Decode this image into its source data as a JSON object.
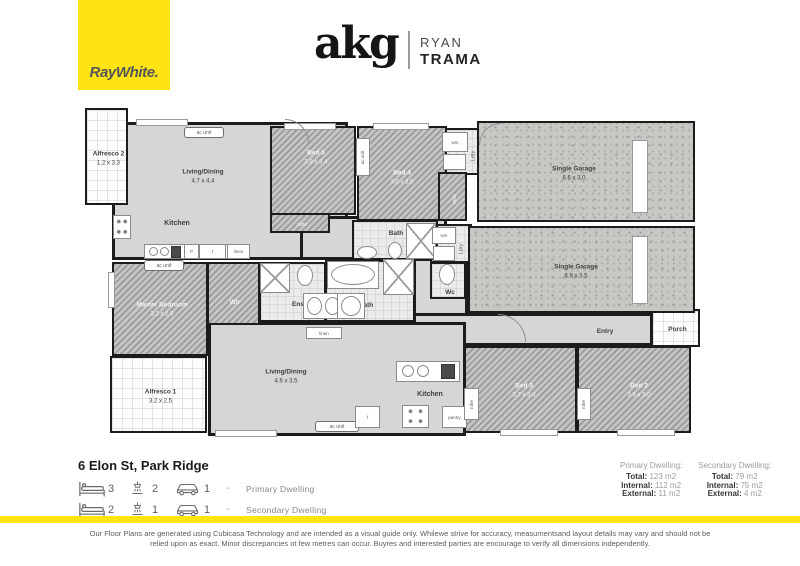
{
  "colors": {
    "brand_yellow": "#FFE313",
    "wall": "#1c1c1c",
    "floor_hard": "#d6d6d4",
    "floor_garage": "#c6c8c3"
  },
  "header": {
    "raywhite_text": "RayWhite.",
    "agency_logo": "akg",
    "agent_first": "RYAN",
    "agent_last": "TRAMA"
  },
  "floorplan": {
    "rooms": [
      {
        "slug": "living-dining-secondary",
        "n": "Living/Dining",
        "d2": "4.7 x 4.4",
        "x": 112,
        "y": 122,
        "w": 236,
        "h": 138,
        "f": "hard",
        "lc": "dark",
        "base": 1,
        "lx": 200,
        "ly": 174
      },
      {
        "slug": "hall-secondary",
        "x": 300,
        "y": 216,
        "w": 147,
        "h": 44,
        "f": "hard",
        "base": 1
      },
      {
        "slug": "hall-primary",
        "x": 413,
        "y": 258,
        "w": 55,
        "h": 62,
        "f": "hard",
        "base": 1
      },
      {
        "slug": "entry",
        "n": "Entry",
        "x": 413,
        "y": 313,
        "w": 240,
        "h": 33,
        "f": "hard",
        "lc": "dark",
        "base": 1,
        "lx": 602,
        "ly": 329
      },
      {
        "slug": "living-dining-primary",
        "n": "Living/Dining",
        "d2": "4.6 x 3.5",
        "x": 208,
        "y": 322,
        "w": 258,
        "h": 114,
        "f": "hard",
        "lc": "dark",
        "base": 1,
        "lx": 283,
        "ly": 374
      },
      {
        "slug": "alfresco-2",
        "n": "Alfresco 2",
        "d2": "1.2 x 3.3",
        "x": 85,
        "y": 108,
        "w": 43,
        "h": 97,
        "f": "tile",
        "lc": "dark"
      },
      {
        "slug": "alfresco-1",
        "n": "Alfresco 1",
        "d2": "3.2 x 2.5",
        "x": 110,
        "y": 356,
        "w": 97,
        "h": 77,
        "f": "tile",
        "lc": "dark"
      },
      {
        "slug": "porch",
        "n": "Porch",
        "x": 651,
        "y": 309,
        "w": 49,
        "h": 38,
        "f": "tile",
        "lc": "dark"
      },
      {
        "slug": "laundry-secondary",
        "x": 438,
        "y": 128,
        "w": 42,
        "h": 47,
        "f": "bathtile"
      },
      {
        "slug": "laundry-primary",
        "x": 430,
        "y": 224,
        "w": 42,
        "h": 39,
        "f": "bathtile"
      },
      {
        "slug": "bath-secondary",
        "n": "Bath",
        "x": 352,
        "y": 220,
        "w": 86,
        "h": 40,
        "f": "bathtile",
        "lc": "dark",
        "lx": 394,
        "ly": 232
      },
      {
        "slug": "ensuite",
        "n": "Ens",
        "x": 259,
        "y": 262,
        "w": 67,
        "h": 60,
        "f": "bathtile",
        "lc": "dark",
        "lx": 296,
        "ly": 303
      },
      {
        "slug": "bath-primary",
        "n": "Bath",
        "x": 325,
        "y": 260,
        "w": 90,
        "h": 62,
        "f": "bathtile",
        "lc": "dark",
        "lx": 364,
        "ly": 304
      },
      {
        "slug": "wc",
        "n": "Wc",
        "x": 430,
        "y": 262,
        "w": 36,
        "h": 37,
        "f": "bathtile",
        "lc": "dark",
        "lx": 448,
        "ly": 291
      },
      {
        "slug": "bed-5",
        "n": "Bed 5",
        "d2": "2.8 x 3.4",
        "x": 270,
        "y": 126,
        "w": 86,
        "h": 89,
        "f": "carpet",
        "lc": "light",
        "lx": 314,
        "ly": 156
      },
      {
        "slug": "robe-bed-5",
        "n": "robe",
        "x": 270,
        "y": 213,
        "w": 60,
        "h": 20,
        "f": "carpet",
        "lc": "light",
        "small": 1
      },
      {
        "slug": "bed-4",
        "n": "Bed 4",
        "d2": "3.0 x 3.0",
        "x": 357,
        "y": 126,
        "w": 90,
        "h": 95,
        "f": "carpet",
        "lc": "light",
        "lx": 400,
        "ly": 176
      },
      {
        "slug": "robe-bed-4",
        "n": "robe",
        "x": 438,
        "y": 172,
        "w": 29,
        "h": 49,
        "f": "carpet",
        "lc": "light",
        "small": 1,
        "v": 1
      },
      {
        "slug": "master-bedroom",
        "n": "Master Bedroom",
        "d2": "3.2 x 2.9",
        "x": 112,
        "y": 262,
        "w": 96,
        "h": 94,
        "f": "carpet",
        "lc": "light",
        "lx": 160,
        "ly": 308
      },
      {
        "slug": "walk-in-robe",
        "n": "WIr",
        "x": 207,
        "y": 262,
        "w": 53,
        "h": 63,
        "f": "carpet",
        "lc": "light",
        "lx": 233,
        "ly": 301
      },
      {
        "slug": "bed-3",
        "n": "Bed 3",
        "d2": "3.7 x 3.0",
        "x": 464,
        "y": 346,
        "w": 113,
        "h": 87,
        "f": "carpet",
        "lc": "light",
        "lx": 522,
        "ly": 389
      },
      {
        "slug": "bed-2",
        "n": "Bed 2",
        "d2": "3.6 x 3.0",
        "x": 577,
        "y": 346,
        "w": 114,
        "h": 87,
        "f": "carpet",
        "lc": "light",
        "lx": 637,
        "ly": 389
      },
      {
        "slug": "garage-secondary",
        "n": "Single Garage",
        "d2": "6.6 x 3.0",
        "x": 477,
        "y": 121,
        "w": 218,
        "h": 101,
        "f": "garage",
        "lc": "dark",
        "lx": 572,
        "ly": 172
      },
      {
        "slug": "garage-primary",
        "n": "Single Garage",
        "d2": "6.9 x 3.5",
        "x": 468,
        "y": 226,
        "w": 227,
        "h": 87,
        "f": "garage",
        "lc": "dark",
        "lx": 574,
        "ly": 270
      }
    ],
    "windows": [
      {
        "x": 136,
        "y": 119,
        "w": 52,
        "h": 7
      },
      {
        "x": 284,
        "y": 123,
        "w": 52,
        "h": 7
      },
      {
        "x": 373,
        "y": 123,
        "w": 56,
        "h": 7
      },
      {
        "x": 632,
        "y": 140,
        "w": 16,
        "h": 73
      },
      {
        "x": 632,
        "y": 236,
        "w": 16,
        "h": 68
      },
      {
        "x": 108,
        "y": 272,
        "w": 7,
        "h": 36
      },
      {
        "x": 215,
        "y": 430,
        "w": 62,
        "h": 7
      },
      {
        "x": 500,
        "y": 429,
        "w": 58,
        "h": 7
      },
      {
        "x": 617,
        "y": 429,
        "w": 58,
        "h": 7
      }
    ],
    "fixtures": [
      {
        "t": "badge",
        "x": 184,
        "y": 127,
        "w": 40,
        "h": 11,
        "l": "ac unit",
        "name": "ac-unit-badge"
      },
      {
        "t": "badge",
        "x": 144,
        "y": 260,
        "w": 40,
        "h": 11,
        "l": "ac unit",
        "name": "ac-unit-badge"
      },
      {
        "t": "badge",
        "x": 315,
        "y": 421,
        "w": 44,
        "h": 11,
        "l": "ac unit",
        "name": "ac-unit-badge"
      },
      {
        "t": "box",
        "x": 356,
        "y": 138,
        "w": 14,
        "h": 38,
        "l": "ac unit",
        "v": 1,
        "name": "ac-unit-badge"
      },
      {
        "t": "dots",
        "x": 113,
        "y": 215,
        "w": 18,
        "h": 24,
        "name": "stove-icon"
      },
      {
        "t": "box",
        "x": 144,
        "y": 244,
        "w": 106,
        "h": 15,
        "name": "kitchen-counter"
      },
      {
        "t": "oval",
        "x": 149,
        "y": 247,
        "w": 9,
        "h": 9,
        "name": "sink-icon"
      },
      {
        "t": "oval",
        "x": 160,
        "y": 247,
        "w": 9,
        "h": 9,
        "name": "sink-icon"
      },
      {
        "t": "dark",
        "x": 171,
        "y": 246,
        "w": 10,
        "h": 12,
        "name": "dishwasher-icon"
      },
      {
        "t": "box",
        "x": 184,
        "y": 244,
        "w": 15,
        "h": 15,
        "l": "P",
        "name": "pantry-box"
      },
      {
        "t": "box",
        "x": 199,
        "y": 244,
        "w": 27,
        "h": 15,
        "l": "f",
        "name": "fridge-box"
      },
      {
        "t": "box",
        "x": 227,
        "y": 244,
        "w": 23,
        "h": 15,
        "l": "linen",
        "name": "linen-box"
      },
      {
        "t": "oval",
        "x": 357,
        "y": 246,
        "w": 20,
        "h": 13,
        "name": "basin-icon"
      },
      {
        "t": "oval",
        "x": 388,
        "y": 242,
        "w": 14,
        "h": 17,
        "name": "toilet-icon"
      },
      {
        "t": "xbox",
        "x": 406,
        "y": 223,
        "w": 30,
        "h": 36,
        "name": "shower-box"
      },
      {
        "t": "box",
        "x": 442,
        "y": 132,
        "w": 26,
        "h": 20,
        "l": "wm",
        "name": "washing-machine-box"
      },
      {
        "t": "box",
        "x": 443,
        "y": 154,
        "w": 23,
        "h": 16,
        "name": "laundry-tub"
      },
      {
        "t": "vtext",
        "x": 464,
        "y": 136,
        "w": 18,
        "h": 40,
        "l": "Ldry",
        "name": "laundry-label"
      },
      {
        "t": "box",
        "x": 432,
        "y": 227,
        "w": 24,
        "h": 17,
        "l": "wm",
        "name": "washing-machine-box"
      },
      {
        "t": "box",
        "x": 433,
        "y": 246,
        "w": 22,
        "h": 15,
        "name": "laundry-tub"
      },
      {
        "t": "vtext",
        "x": 453,
        "y": 231,
        "w": 16,
        "h": 36,
        "l": "Ldry",
        "name": "laundry-label"
      },
      {
        "t": "oval",
        "x": 439,
        "y": 264,
        "w": 16,
        "h": 21,
        "name": "toilet-icon"
      },
      {
        "t": "box",
        "x": 327,
        "y": 261,
        "w": 52,
        "h": 28,
        "name": "bathtub-icon"
      },
      {
        "t": "oval",
        "x": 331,
        "y": 264,
        "w": 44,
        "h": 21,
        "name": "bathtub-icon"
      },
      {
        "t": "xbox",
        "x": 383,
        "y": 259,
        "w": 31,
        "h": 36,
        "name": "shower-box"
      },
      {
        "t": "xbox",
        "x": 260,
        "y": 263,
        "w": 30,
        "h": 30,
        "name": "shower-box"
      },
      {
        "t": "oval",
        "x": 297,
        "y": 265,
        "w": 16,
        "h": 21,
        "name": "toilet-icon"
      },
      {
        "t": "box",
        "x": 303,
        "y": 293,
        "w": 41,
        "h": 26,
        "name": "vanity-counter"
      },
      {
        "t": "oval",
        "x": 307,
        "y": 297,
        "w": 15,
        "h": 18,
        "name": "basin-icon"
      },
      {
        "t": "oval",
        "x": 325,
        "y": 297,
        "w": 15,
        "h": 18,
        "name": "basin-icon"
      },
      {
        "t": "box",
        "x": 337,
        "y": 293,
        "w": 28,
        "h": 26,
        "name": "vanity-counter"
      },
      {
        "t": "oval",
        "x": 341,
        "y": 296,
        "w": 20,
        "h": 20,
        "name": "basin-icon"
      },
      {
        "t": "box",
        "x": 396,
        "y": 361,
        "w": 64,
        "h": 21,
        "name": "kitchen-island"
      },
      {
        "t": "oval",
        "x": 402,
        "y": 365,
        "w": 12,
        "h": 12,
        "name": "sink-icon"
      },
      {
        "t": "oval",
        "x": 417,
        "y": 365,
        "w": 12,
        "h": 12,
        "name": "sink-icon"
      },
      {
        "t": "dark",
        "x": 441,
        "y": 364,
        "w": 14,
        "h": 15,
        "name": "dishwasher-icon"
      },
      {
        "t": "box",
        "x": 355,
        "y": 406,
        "w": 25,
        "h": 22,
        "l": "f",
        "name": "fridge-box"
      },
      {
        "t": "dots",
        "x": 402,
        "y": 405,
        "w": 27,
        "h": 23,
        "name": "stove-icon"
      },
      {
        "t": "box",
        "x": 442,
        "y": 406,
        "w": 25,
        "h": 22,
        "l": "pantry",
        "name": "pantry-box"
      },
      {
        "t": "box",
        "x": 306,
        "y": 327,
        "w": 36,
        "h": 12,
        "l": "linen",
        "name": "linen-box"
      },
      {
        "t": "box",
        "x": 464,
        "y": 388,
        "w": 15,
        "h": 32,
        "l": "robe",
        "v": 1,
        "name": "robe-box"
      },
      {
        "t": "box",
        "x": 577,
        "y": 388,
        "w": 14,
        "h": 32,
        "l": "robe",
        "v": 1,
        "name": "robe-box"
      },
      {
        "t": "text",
        "x": 145,
        "y": 217,
        "w": 64,
        "h": 12,
        "l": "Kitchen",
        "name": "kitchen-label"
      },
      {
        "t": "text",
        "x": 398,
        "y": 388,
        "w": 64,
        "h": 12,
        "l": "Kitchen",
        "name": "kitchen-label"
      },
      {
        "t": "arc",
        "x": 285,
        "y": 119,
        "w": 24,
        "h": 24,
        "r": "tr",
        "name": "door-arc"
      },
      {
        "t": "arc",
        "x": 498,
        "y": 314,
        "w": 28,
        "h": 28,
        "r": "tr",
        "name": "door-arc"
      },
      {
        "t": "arc",
        "x": 479,
        "y": 123,
        "w": 22,
        "h": 22,
        "r": "tl",
        "name": "door-arc"
      }
    ]
  },
  "footer": {
    "address": "6 Elon St, Park Ridge",
    "specs": [
      {
        "beds": "3",
        "baths": "2",
        "cars": "1",
        "separator": "-",
        "label": "Primary Dwelling"
      },
      {
        "beds": "2",
        "baths": "1",
        "cars": "1",
        "separator": "-",
        "label": "Secondary Dwelling"
      }
    ],
    "areas": [
      {
        "title": "Primary Dwelling:",
        "rows": [
          {
            "k": "Total:",
            "v": "123 m2"
          },
          {
            "k": "Internal:",
            "v": "112 m2"
          },
          {
            "k": "External:",
            "v": "11 m2"
          }
        ]
      },
      {
        "title": "Secondary Dwelling:",
        "rows": [
          {
            "k": "Total:",
            "v": "79 m2"
          },
          {
            "k": "Internal:",
            "v": "75 m2"
          },
          {
            "k": "External:",
            "v": "4 m2"
          }
        ]
      }
    ],
    "disclaimer_line1": "Our Floor Plans are generated using Cubicasa Technology and are intended as a visual guide only. Whilewe strive for accuracy, measumentsand layout details may vary and should not be",
    "disclaimer_line2": "relied upon as exact. Minor discrepancies ot few metres can occur. Buyres and interested parties are encourage to verify all dimensions independently."
  }
}
